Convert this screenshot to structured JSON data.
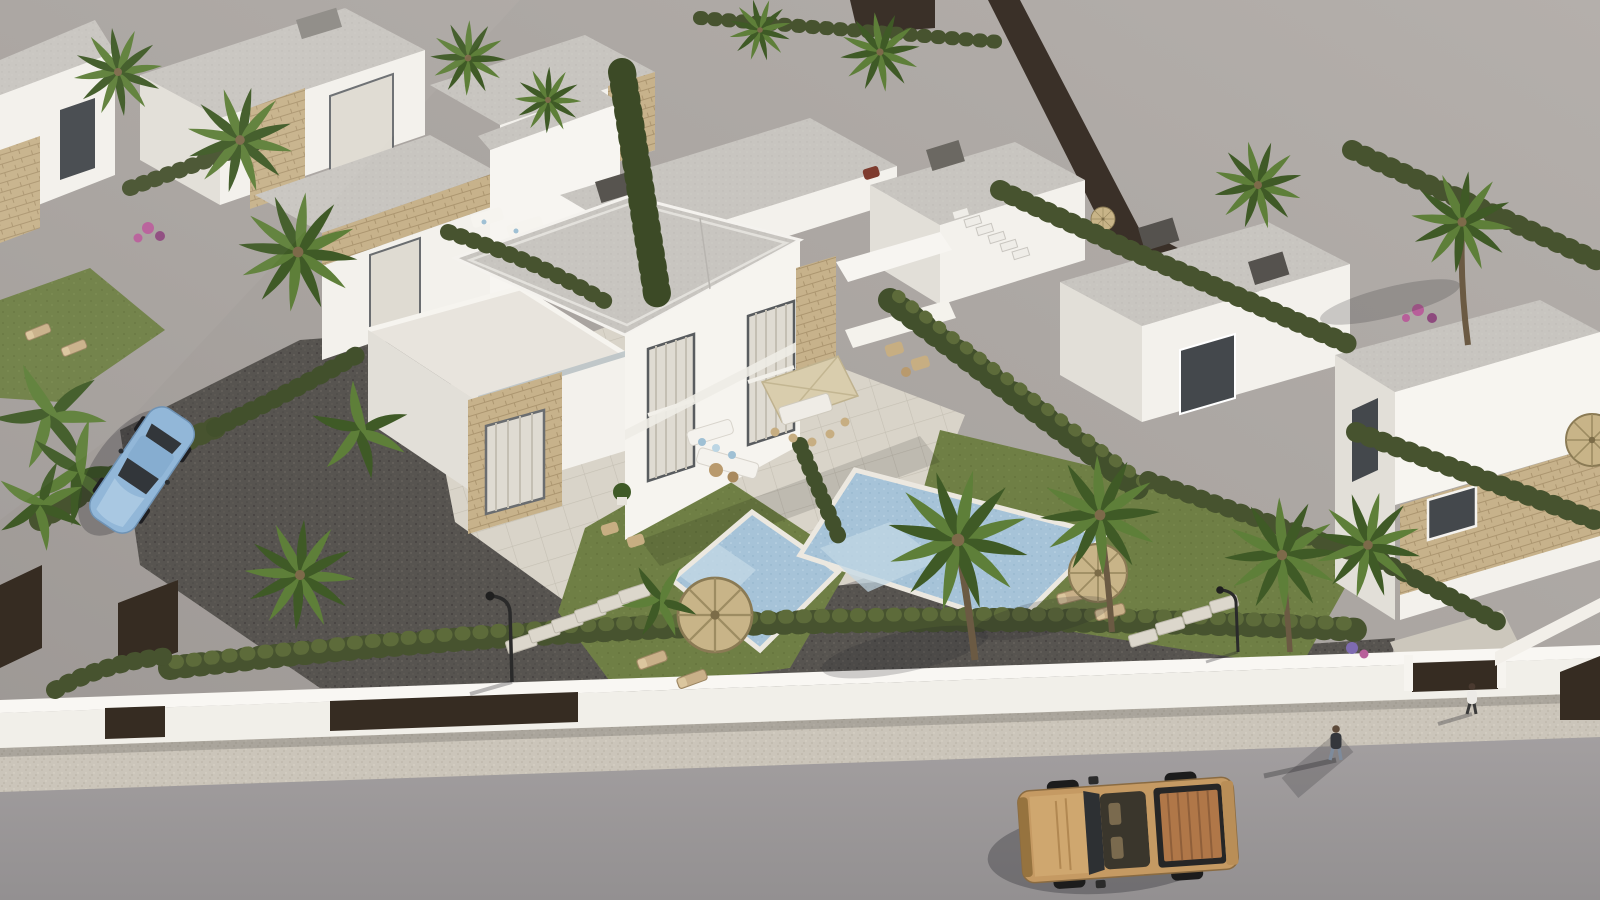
{
  "title": "Aerial 3D architectural render of a modern white villa development",
  "palette": {
    "ground": "#aca7a3",
    "ground2": "#9d9895",
    "street": "#9c9899",
    "street2": "#8f8c8d",
    "sidewalk": "#cbc5ba",
    "wall": "#f1efe9",
    "walltop": "#f9f7f3",
    "building": "#f3f1ec",
    "shade": "#e2dfd8",
    "shade2": "#d3d0c9",
    "roof": "#c8c5c0",
    "stone": "#c7b28b",
    "stone2": "#b09a74",
    "hedge": "#47532f",
    "hedge2": "#5d6b3a",
    "lawn": "#6f7f45",
    "palm": "#5e7f39",
    "palmdark": "#3f5a26",
    "pool": "#a6c3d8",
    "poollight": "#c3d8e5",
    "gravel": "#575450",
    "paver": "#d9d4c9",
    "straw": "#c8b488",
    "orange": "#c2653c",
    "truck": "#c59a63",
    "truckbed": "#b07748",
    "car": "#92b7d8",
    "glass": "#44484c",
    "curtain": "#dfdbd2",
    "brown": "#362c22",
    "flower": "#b85f9a",
    "trunk": "#6b5a43"
  },
  "scene": {
    "style": "photorealistic aerial 3D render, daytime, sun from upper right",
    "elements": [
      "rows of white flat-roof villas with beige stone cladding",
      "central semi-detached two-storey villa with curtained glass bays",
      "two private swimming pools with light blue water",
      "thatched straw parasols and sun loungers",
      "cream square dining parasol with outdoor sofa and dining set",
      "palm trees, banana plants and cypress hedges",
      "dark gravel driveways with stepping stones and street lamp",
      "white perimeter wall with dark brown entry gates",
      "beige speckled sidewalk and grey asphalt street",
      "empty graded land beyond the development",
      "pink bougainvillea shrubs",
      "small orange parasol by a neighbour pool"
    ]
  },
  "vehicles": [
    {
      "label": "pickup-truck",
      "color_name": "tan, parked on street"
    },
    {
      "label": "convertible-car",
      "color_name": "light blue, parked on gravel drive"
    }
  ],
  "people": [
    {
      "label": "pedestrian-on-sidewalk",
      "clothing": "dark top, jeans"
    },
    {
      "label": "person-at-gate",
      "clothing": "white top, dark trousers"
    }
  ]
}
